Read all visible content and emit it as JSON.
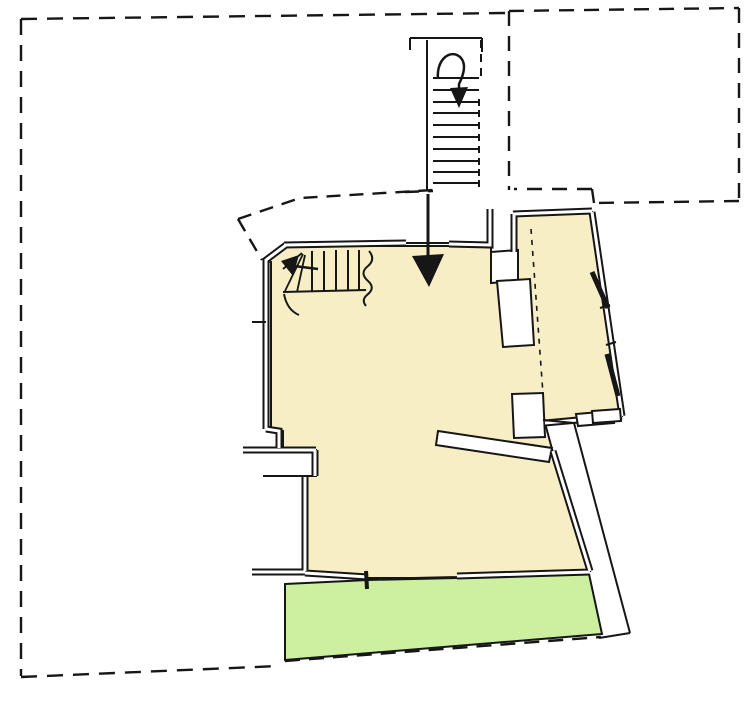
{
  "image": {
    "kind": "architectural floor plan sketch (ground floor with site boundary)",
    "has_text": false
  },
  "colors": {
    "background": "#ffffff",
    "ink": "#161616",
    "interior_fill": "#F7EEC6",
    "terrace_fill": "#CCEFA0",
    "mask": "#ffffff"
  },
  "regions": [
    {
      "id": "site-boundary-left",
      "label": "main site parcel (dashed outline)"
    },
    {
      "id": "site-boundary-right",
      "label": "adjacent parcel (dashed outline)"
    },
    {
      "id": "external-staircase",
      "label": "external staircase with down arrow"
    },
    {
      "id": "building-interior",
      "label": "interior rooms (cream fill)"
    },
    {
      "id": "terrace",
      "label": "terrace / garden strip (green fill)"
    },
    {
      "id": "internal-winder-stair",
      "label": "internal winder staircase"
    },
    {
      "id": "entrance",
      "label": "entrance opening with direction arrow"
    }
  ],
  "annotations": {
    "external_stair_arrow": "down",
    "entrance_arrow": "down",
    "internal_stair_arrow": "left"
  }
}
